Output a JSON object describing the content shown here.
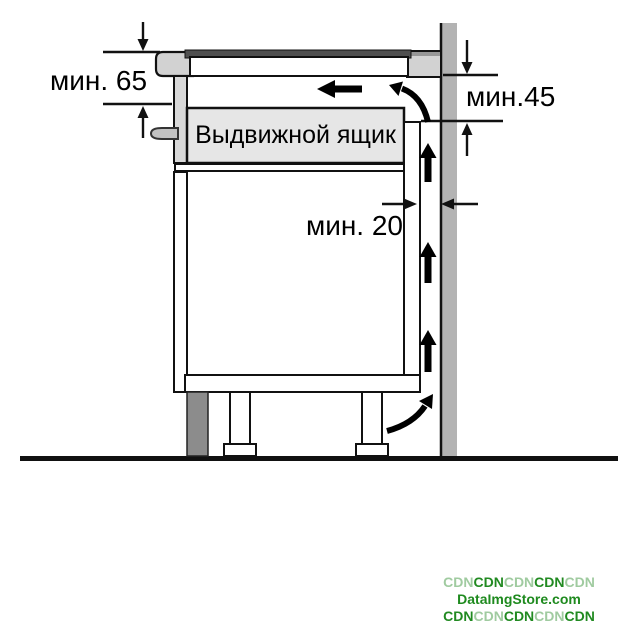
{
  "diagram": {
    "title_semantic": "hob-installation-clearance-diagram",
    "labels": {
      "dim_top_left": "мин. 65",
      "dim_top_right": "мин.45",
      "dim_gap": "мин. 20",
      "drawer": "Выдвижной ящик"
    },
    "colors": {
      "line": "#111111",
      "wall": "#b3b3b3",
      "worktop": "#d2d2d2",
      "worktop_top_edge": "#969696",
      "glass": "#4f4f4f",
      "hob_body": "#ffffff",
      "drawer_fill": "#e6e6e6",
      "drawer_front": "#d9d9d9",
      "handle": "#c2c2c2",
      "plinth": "#8c8c8c",
      "cabinet_fill": "#ffffff",
      "arrow": "#000000",
      "watermark_light": "#a0cba0",
      "watermark_dark": "#218a21"
    }
  },
  "watermark": {
    "line1": [
      "CDN",
      "CDN",
      "CDN",
      "CDN",
      "CDN"
    ],
    "line2": "DataImgStore.com",
    "line3": [
      "CDN",
      "CDN",
      "CDN",
      "CDN",
      "CDN"
    ]
  }
}
